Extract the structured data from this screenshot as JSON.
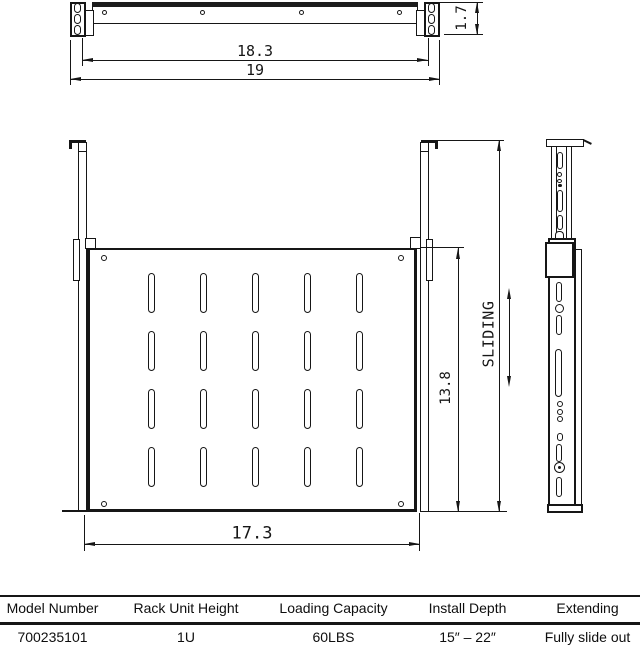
{
  "drawing": {
    "top_view": {
      "dim_inner_width": "18.3",
      "dim_outer_width": "19",
      "dim_panel_height": "1.7",
      "panel_holes": 4,
      "ear_slots_per_side": 3
    },
    "front_view": {
      "dim_shelf_width": "17.3",
      "dim_shelf_depth": "13.8",
      "sliding_label": "SLIDING",
      "vent_slot_rows": 4,
      "vent_slot_cols": 5
    },
    "colors": {
      "line": "#161616",
      "background": "#ffffff"
    }
  },
  "table": {
    "headers": [
      "Model Number",
      "Rack Unit Height",
      "Loading Capacity",
      "Install Depth",
      "Extending"
    ],
    "row": [
      "700235101",
      "1U",
      "60LBS",
      "15″ – 22″",
      "Fully slide out"
    ]
  }
}
